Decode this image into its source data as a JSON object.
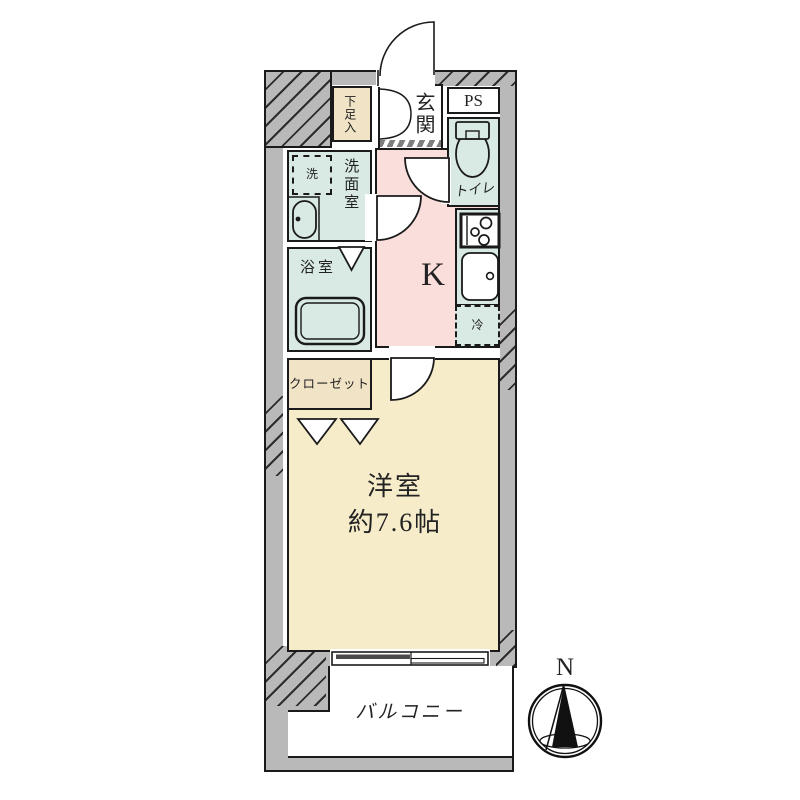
{
  "plan": {
    "labels": {
      "shoe_cabinet": "下足入",
      "entrance": "玄関",
      "pipe_space": "PS",
      "toilet": "トイレ",
      "laundry": "洗",
      "washroom": "洗面室",
      "bathroom": "浴室",
      "closet": "クローゼット",
      "kitchen": "K",
      "refrigerator": "冷",
      "main_room_name": "洋室",
      "main_room_size": "約7.6帖",
      "balcony": "バルコニー",
      "compass_north": "N"
    },
    "colors": {
      "wall": "#b9b9b9",
      "wet_area": "#d9eae5",
      "kitchen_floor": "#f9dedb",
      "main_room_floor": "#f6ecca",
      "storage": "#f1e3c5",
      "line": "#1a1a1a"
    }
  }
}
